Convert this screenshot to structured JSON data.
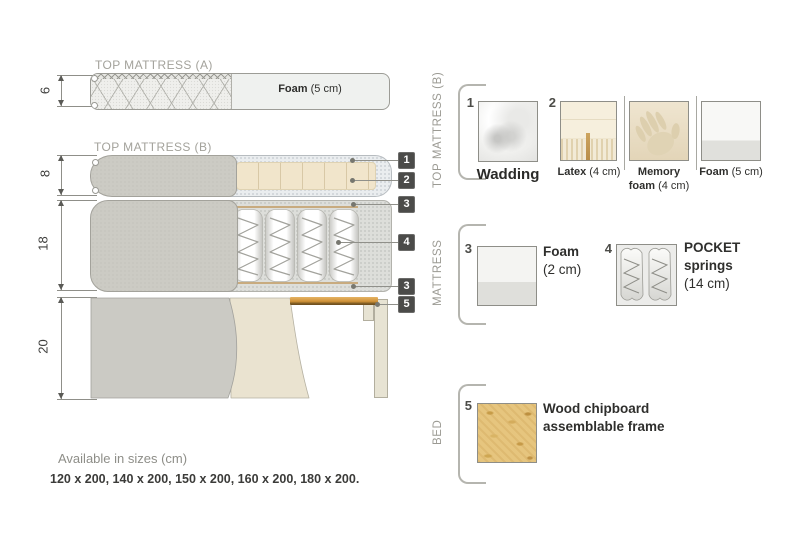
{
  "colors": {
    "fabric_gray": "#cccbc4",
    "latex_beige": "#f1e5cb",
    "wood_slat": "#d3983e",
    "tag_background": "#4b4b49",
    "text_dark": "#3b3b39",
    "text_gray": "#9b9a93"
  },
  "diagram": {
    "top_mattress_a": {
      "title": "TOP MATTRESS (A)",
      "dimension": "6",
      "foam_bold": "Foam",
      "foam_rest": " (5 cm)"
    },
    "top_mattress_b": {
      "title": "TOP MATTRESS (B)",
      "dimension": "8"
    },
    "mattress": {
      "dimension": "18"
    },
    "bed": {
      "dimension": "20"
    },
    "tags": [
      {
        "label": "1"
      },
      {
        "label": "2"
      },
      {
        "label": "3"
      },
      {
        "label": "4"
      },
      {
        "label": "3"
      },
      {
        "label": "5"
      }
    ]
  },
  "legend": {
    "top_mattress_b": {
      "section_label": "TOP MATTRESS (B)",
      "items": [
        {
          "num": "1",
          "bold": "Wadding"
        },
        {
          "num": "2",
          "bold": "Latex",
          "rest": " (4 cm)"
        },
        {
          "num": "",
          "bold1": "Memory",
          "bold2": "foam",
          "rest": " (4 cm)"
        },
        {
          "num": "",
          "bold": "Foam",
          "rest": " (5 cm)"
        }
      ]
    },
    "mattress": {
      "section_label": "MATTRESS",
      "items": [
        {
          "num": "3",
          "bold": "Foam",
          "rest": "(2 cm)"
        },
        {
          "num": "4",
          "bold1": "POCKET",
          "bold2": "springs",
          "rest": "(14 cm)"
        }
      ]
    },
    "bed": {
      "section_label": "BED",
      "items": [
        {
          "num": "5",
          "line1": "Wood chipboard",
          "line2": "assemblable frame"
        }
      ]
    }
  },
  "footer": {
    "sizes_title": "Available in sizes (cm)",
    "sizes_list": "120 x 200, 140 x 200, 150 x 200, 160 x 200, 180 x 200."
  }
}
